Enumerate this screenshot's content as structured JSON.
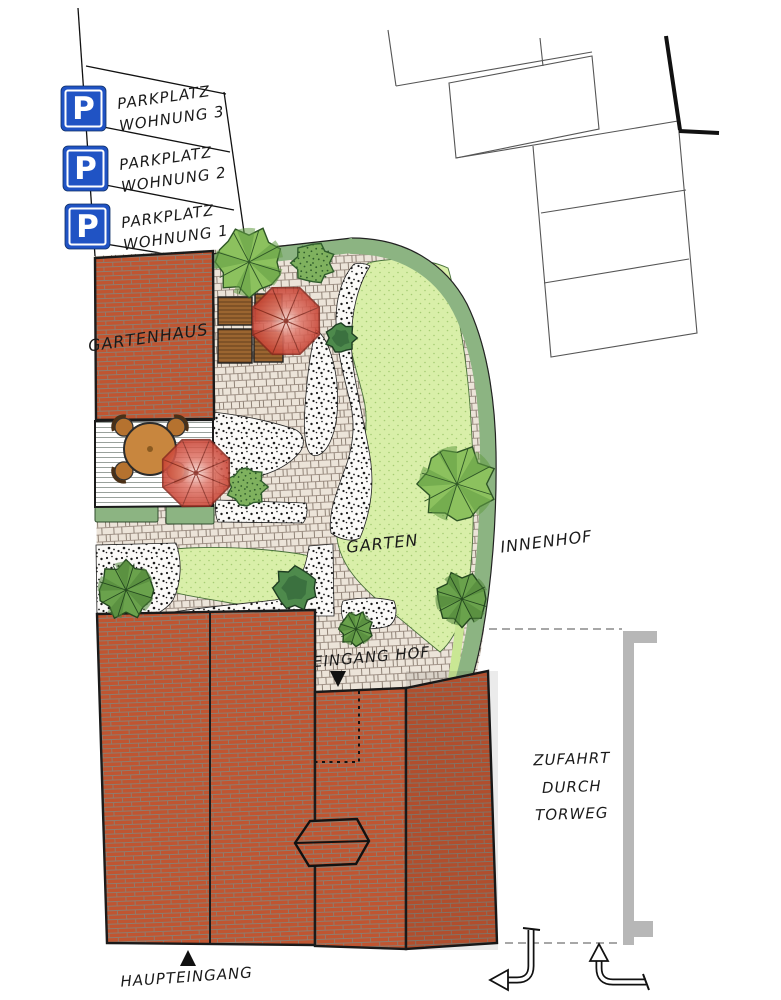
{
  "parking": {
    "sign_letter": "P",
    "stalls": [
      {
        "line1": "PARKPLATZ",
        "line2": "WOHNUNG 3"
      },
      {
        "line1": "PARKPLATZ",
        "line2": "WOHNUNG 2"
      },
      {
        "line1": "PARKPLATZ",
        "line2": "WOHNUNG 1"
      }
    ]
  },
  "areas": {
    "gartenhaus": "GARTENHAUS",
    "garten": "GARTEN",
    "innenhof": "INNENHOF"
  },
  "entrances": {
    "eingang_hof": "EINGANG HOF",
    "haupteingang": "HAUPTEINGANG"
  },
  "driveway": {
    "line1": "ZUFAHRT",
    "line2": "DURCH",
    "line3": "TORWEG"
  },
  "icons": {
    "parking_sign": "blue-square-white-P",
    "entrance_marker": "filled-black-triangle",
    "turn_arrow_left": "elbow-arrow-down-then-left",
    "turn_arrow_up": "elbow-arrow-left-then-up",
    "parasol": "red-garden-umbrella",
    "tree": "round-tree-plan-symbol"
  },
  "colors": {
    "sign_blue": "#2053c4",
    "brick_red": "#c05531",
    "lawn_green": "#d9efa9",
    "hedge_green": "#8cb482",
    "paving_beige": "#ece4d9",
    "parasol_red": "#d85045",
    "wall_gray": "#b7b7b7"
  }
}
